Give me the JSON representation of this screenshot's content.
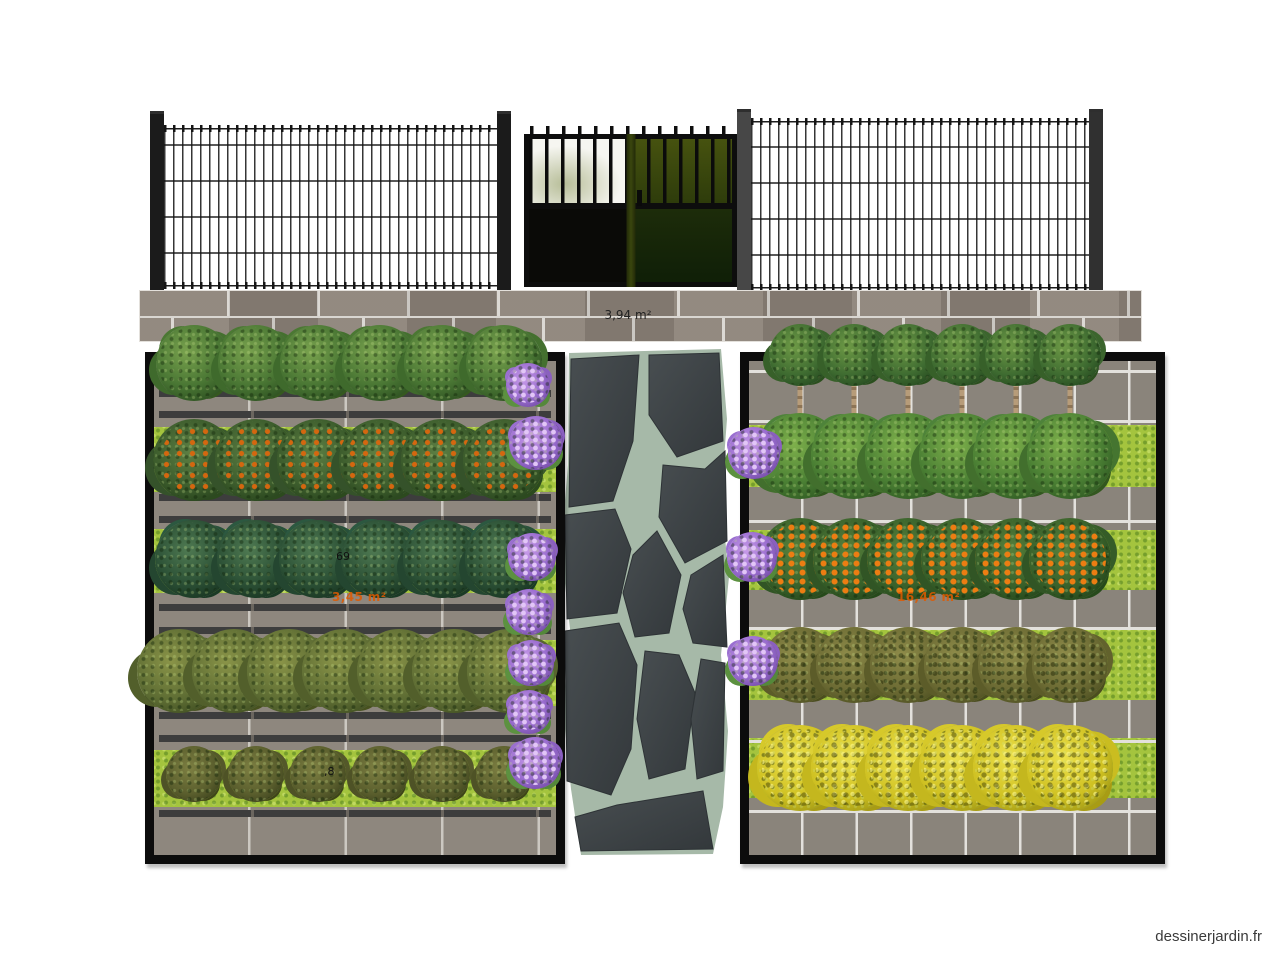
{
  "watermark": "dessinerjardin.fr",
  "labels": {
    "paved_area": "3,94 m²",
    "left_plant_count": "69",
    "left_bed_area": "3,45 m²",
    "left_bottom_fragment": ",8",
    "right_bed_area": "16,46 m²"
  },
  "colors": {
    "accent_orange": "#e05a00",
    "frame_black": "#0c0c0c",
    "grass_green": "#a4c43e",
    "pavement_grey": "#8e877e",
    "stone_dark": "#3d4245",
    "stone_joint": "#a6b9a8",
    "flower_purple": "#9b6ed0"
  },
  "plots": [
    {
      "name": "left-garden-plot",
      "x": 145,
      "y": 352,
      "w": 402,
      "h": 494,
      "surface": "pav-left",
      "x0": 40,
      "dx": 62,
      "grass": [
        {
          "y": 66,
          "h": 65
        },
        {
          "y": 168,
          "h": 64
        },
        {
          "y": 279,
          "h": 66
        },
        {
          "y": 389,
          "h": 57
        }
      ],
      "rails": [
        29,
        50,
        133,
        155,
        243,
        266,
        351,
        374,
        449
      ],
      "groutH": [],
      "rows": [
        {
          "type": "tree-green",
          "cy": 2,
          "s": 76
        },
        {
          "type": "shrub-fruit",
          "cy": 99,
          "s": 82
        },
        {
          "type": "conifer",
          "cy": 198,
          "s": 78
        },
        {
          "type": "tree-olive",
          "cy": 310,
          "s": 84,
          "count": 7,
          "x0": 25,
          "dx": 55
        },
        {
          "type": "tree-small",
          "cy": 413,
          "s": 56,
          "trunk": 24
        }
      ],
      "labels": [
        {
          "t": "69",
          "x": 182,
          "y": 190,
          "cls": "lbl-black",
          "name": "plant-count-label"
        },
        {
          "t": "3,45 m²",
          "x": 178,
          "y": 230,
          "cls": "lbl-orange",
          "name": "bed-area-label"
        },
        {
          "t": ",8",
          "x": 170,
          "y": 405,
          "cls": "lbl-black",
          "name": "measure-fragment-label"
        }
      ]
    },
    {
      "name": "right-garden-plot",
      "x": 740,
      "y": 352,
      "w": 407,
      "h": 494,
      "surface": "pav-right",
      "x0": 51,
      "dx": 54,
      "grass": [
        {
          "y": 64,
          "h": 62
        },
        {
          "y": 169,
          "h": 60
        },
        {
          "y": 269,
          "h": 70
        },
        {
          "y": 377,
          "h": 60
        }
      ],
      "rails": [],
      "groutH": [
        9,
        59,
        159,
        266,
        379,
        449
      ],
      "rows": [
        {
          "type": "tree-std",
          "cy": -6,
          "s": 62,
          "trunk": 58
        },
        {
          "type": "tree-round",
          "cy": 95,
          "s": 86,
          "trunk": 22
        },
        {
          "type": "tree-orange",
          "cy": 198,
          "s": 82,
          "trunk": 30
        },
        {
          "type": "shrub-brown",
          "cy": 304,
          "s": 76
        },
        {
          "type": "shrub-yellow",
          "cy": 407,
          "s": 86
        }
      ],
      "labels": [
        {
          "t": "16,46 m²",
          "x": 148,
          "y": 230,
          "cls": "lbl-orange",
          "name": "bed-area-label"
        }
      ]
    }
  ],
  "path_flowers": [
    {
      "x": 528,
      "y": 385,
      "s": 44
    },
    {
      "x": 536,
      "y": 443,
      "s": 54
    },
    {
      "x": 532,
      "y": 557,
      "s": 48
    },
    {
      "x": 529,
      "y": 612,
      "s": 46
    },
    {
      "x": 531,
      "y": 663,
      "s": 46
    },
    {
      "x": 529,
      "y": 712,
      "s": 44
    },
    {
      "x": 535,
      "y": 763,
      "s": 52
    },
    {
      "x": 754,
      "y": 453,
      "s": 52
    },
    {
      "x": 752,
      "y": 557,
      "s": 50
    },
    {
      "x": 753,
      "y": 661,
      "s": 50
    }
  ]
}
